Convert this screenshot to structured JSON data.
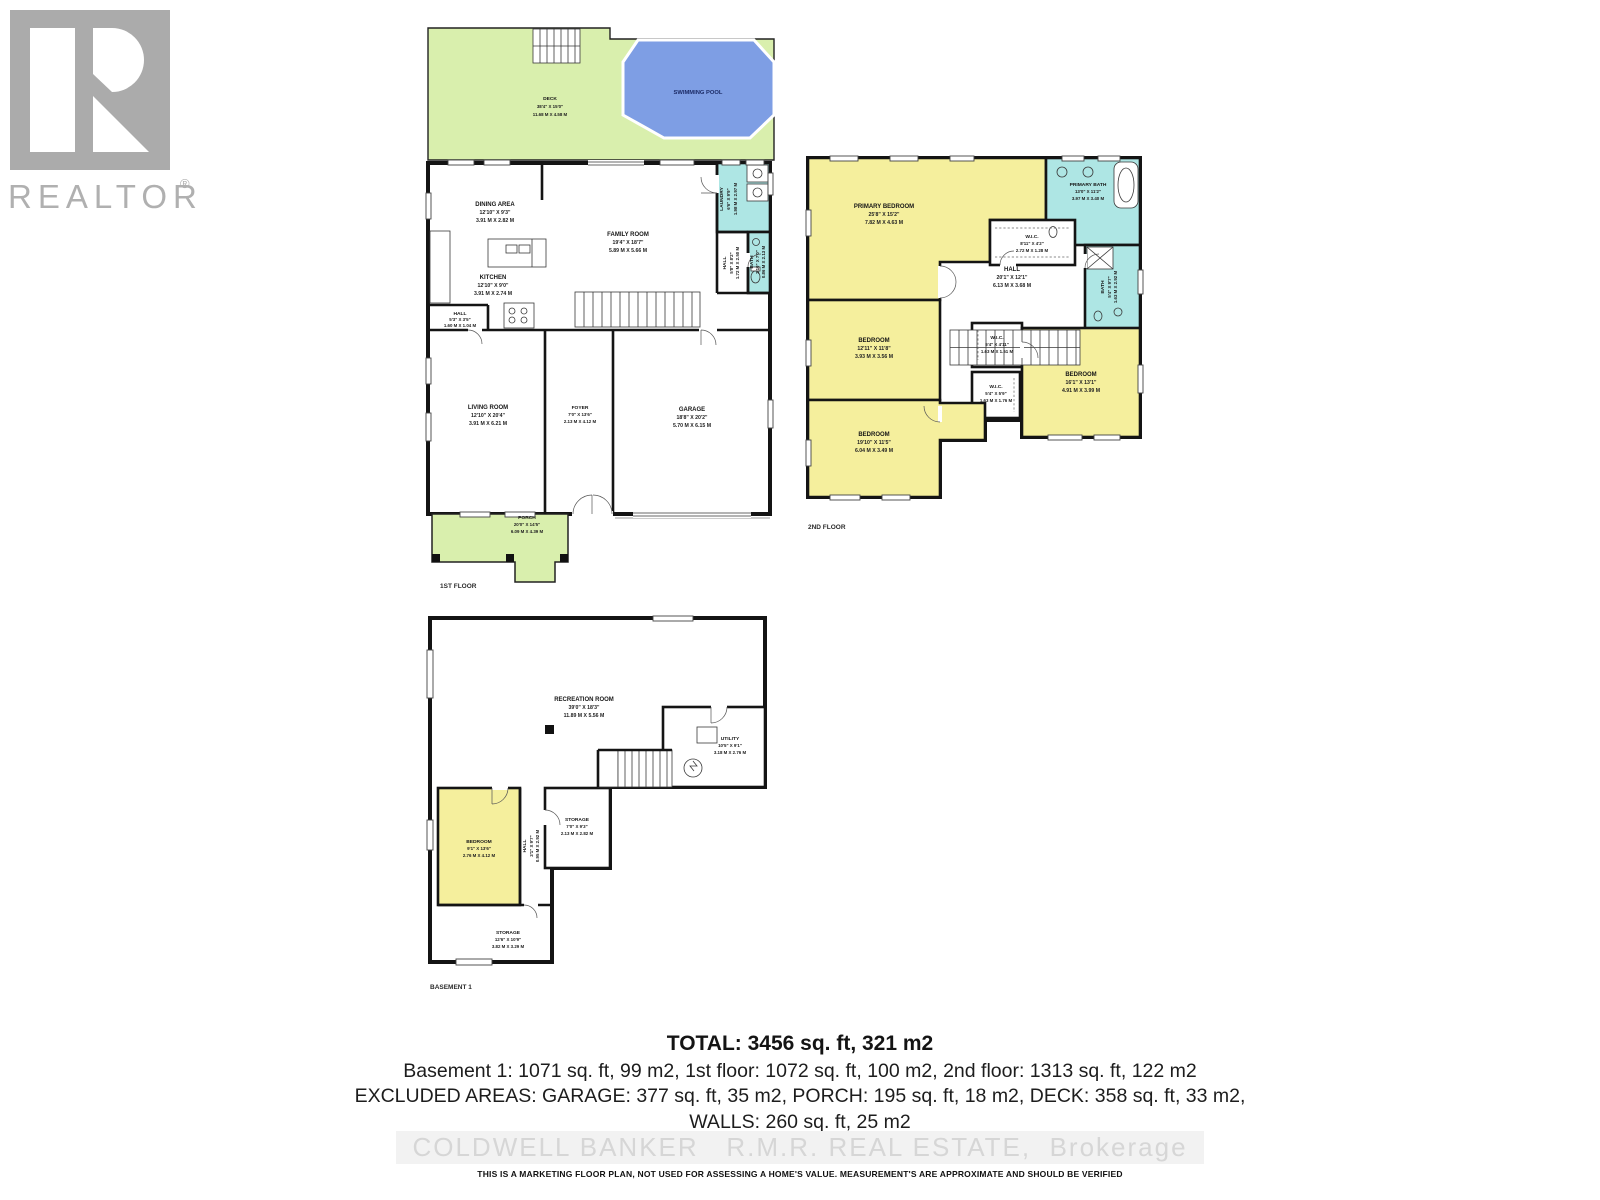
{
  "watermark": {
    "brand": "REALTOR",
    "registered": "®"
  },
  "colors": {
    "wall": "#141414",
    "deck_green": "#d9efad",
    "pool_blue": "#7e9ee4",
    "wet_cyan": "#aee6e4",
    "bedroom_yellow": "#f5ef9d",
    "logo_gray": "#ababab",
    "watermark_gray": "#d6d6d6"
  },
  "floors": [
    {
      "label": "1ST FLOOR",
      "rooms": [
        {
          "name": "DECK",
          "dims_ft": "38'4\" X 15'0\"",
          "dims_m": "11.68 M X 4.58 M"
        },
        {
          "name": "SWIMMING POOL"
        },
        {
          "name": "DINING AREA",
          "dims_ft": "12'10\" X 9'3\"",
          "dims_m": "3.91 M X 2.82 M"
        },
        {
          "name": "KITCHEN",
          "dims_ft": "12'10\" X 9'0\"",
          "dims_m": "3.91 M X 2.74 M"
        },
        {
          "name": "HALL",
          "dims_ft": "5'3\" X 3'5\"",
          "dims_m": "1.60 M X 1.04 M"
        },
        {
          "name": "FAMILY ROOM",
          "dims_ft": "19'4\" X 18'7\"",
          "dims_m": "5.89 M X 5.66 M"
        },
        {
          "name": "LAUNDRY",
          "dims_ft": "6'6\" X 9'9\"",
          "dims_m": "1.98 M X 2.97 M"
        },
        {
          "name": "BATH",
          "dims_ft": "2'10\" X 7'0\"",
          "dims_m": "0.86 M X 2.13 M"
        },
        {
          "name": "HALL",
          "dims_ft": "5'8\" X 8'2\"",
          "dims_m": "1.72 M X 2.50 M"
        },
        {
          "name": "LIVING ROOM",
          "dims_ft": "12'10\" X 20'4\"",
          "dims_m": "3.91 M X 6.21 M"
        },
        {
          "name": "FOYER",
          "dims_ft": "7'0\" X 13'6\"",
          "dims_m": "2.13 M X 4.12 M"
        },
        {
          "name": "GARAGE",
          "dims_ft": "18'8\" X 20'2\"",
          "dims_m": "5.70 M X 6.15 M"
        },
        {
          "name": "PORCH",
          "dims_ft": "20'0\" X 14'5\"",
          "dims_m": "6.09 M X 4.39 M"
        }
      ]
    },
    {
      "label": "2ND FLOOR",
      "rooms": [
        {
          "name": "PRIMARY BEDROOM",
          "dims_ft": "25'8\" X 15'2\"",
          "dims_m": "7.82 M X 4.63 M"
        },
        {
          "name": "PRIMARY BATH",
          "dims_ft": "13'0\" X 11'2\"",
          "dims_m": "3.97 M X 3.40 M"
        },
        {
          "name": "W.I.C.",
          "dims_ft": "8'11\" X 4'2\"",
          "dims_m": "2.72 M X 1.28 M"
        },
        {
          "name": "HALL",
          "dims_ft": "20'1\" X 12'1\"",
          "dims_m": "6.13 M X 3.68 M"
        },
        {
          "name": "BATH",
          "dims_ft": "5'4\" X 9'7\"",
          "dims_m": "1.63 M X 2.92 M"
        },
        {
          "name": "BEDROOM",
          "dims_ft": "12'11\" X 11'8\"",
          "dims_m": "3.93 M X 3.56 M"
        },
        {
          "name": "W.I.C.",
          "dims_ft": "5'4\" X 4'11\"",
          "dims_m": "1.63 M X 1.51 M"
        },
        {
          "name": "W.I.C.",
          "dims_ft": "5'4\" X 5'9\"",
          "dims_m": "1.63 M X 1.76 M"
        },
        {
          "name": "BEDROOM",
          "dims_ft": "16'1\" X 13'1\"",
          "dims_m": "4.91 M X 3.99 M"
        },
        {
          "name": "BEDROOM",
          "dims_ft": "19'10\" X 11'5\"",
          "dims_m": "6.04 M X 3.49 M"
        }
      ]
    },
    {
      "label": "BASEMENT 1",
      "rooms": [
        {
          "name": "RECREATION ROOM",
          "dims_ft": "39'0\" X 18'3\"",
          "dims_m": "11.89 M X 5.56 M"
        },
        {
          "name": "UTILITY",
          "dims_ft": "10'5\" X 9'1\"",
          "dims_m": "3.18 M X 2.76 M"
        },
        {
          "name": "BEDROOM",
          "dims_ft": "9'1\" X 13'6\"",
          "dims_m": "2.76 M X 4.12 M"
        },
        {
          "name": "HALL",
          "dims_ft": "3'1\" X 9'7\"",
          "dims_m": "0.95 M X 2.92 M"
        },
        {
          "name": "STORAGE",
          "dims_ft": "7'0\" X 9'3\"",
          "dims_m": "2.13 M X 2.82 M"
        },
        {
          "name": "STORAGE",
          "dims_ft": "12'6\" X 10'9\"",
          "dims_m": "3.82 M X 3.29 M"
        }
      ]
    }
  ],
  "summary": {
    "total": "TOTAL: 3456 sq. ft, 321 m2",
    "line1": "Basement 1: 1071 sq. ft, 99 m2, 1st floor: 1072 sq. ft, 100 m2, 2nd floor: 1313 sq. ft, 122 m2",
    "line2": "EXCLUDED AREAS: GARAGE: 377 sq. ft, 35 m2, PORCH: 195 sq. ft, 18 m2, DECK: 358 sq. ft, 33 m2,",
    "line3": "WALLS: 260 sq. ft, 25 m2",
    "brokerage": "COLDWELL BANKER   R.M.R. REAL ESTATE,  Brokerage",
    "disclaimer": "THIS IS A MARKETING FLOOR PLAN, NOT USED FOR ASSESSING A HOME'S VALUE. MEASUREMENT'S ARE APPROXIMATE AND SHOULD BE VERIFIED"
  }
}
